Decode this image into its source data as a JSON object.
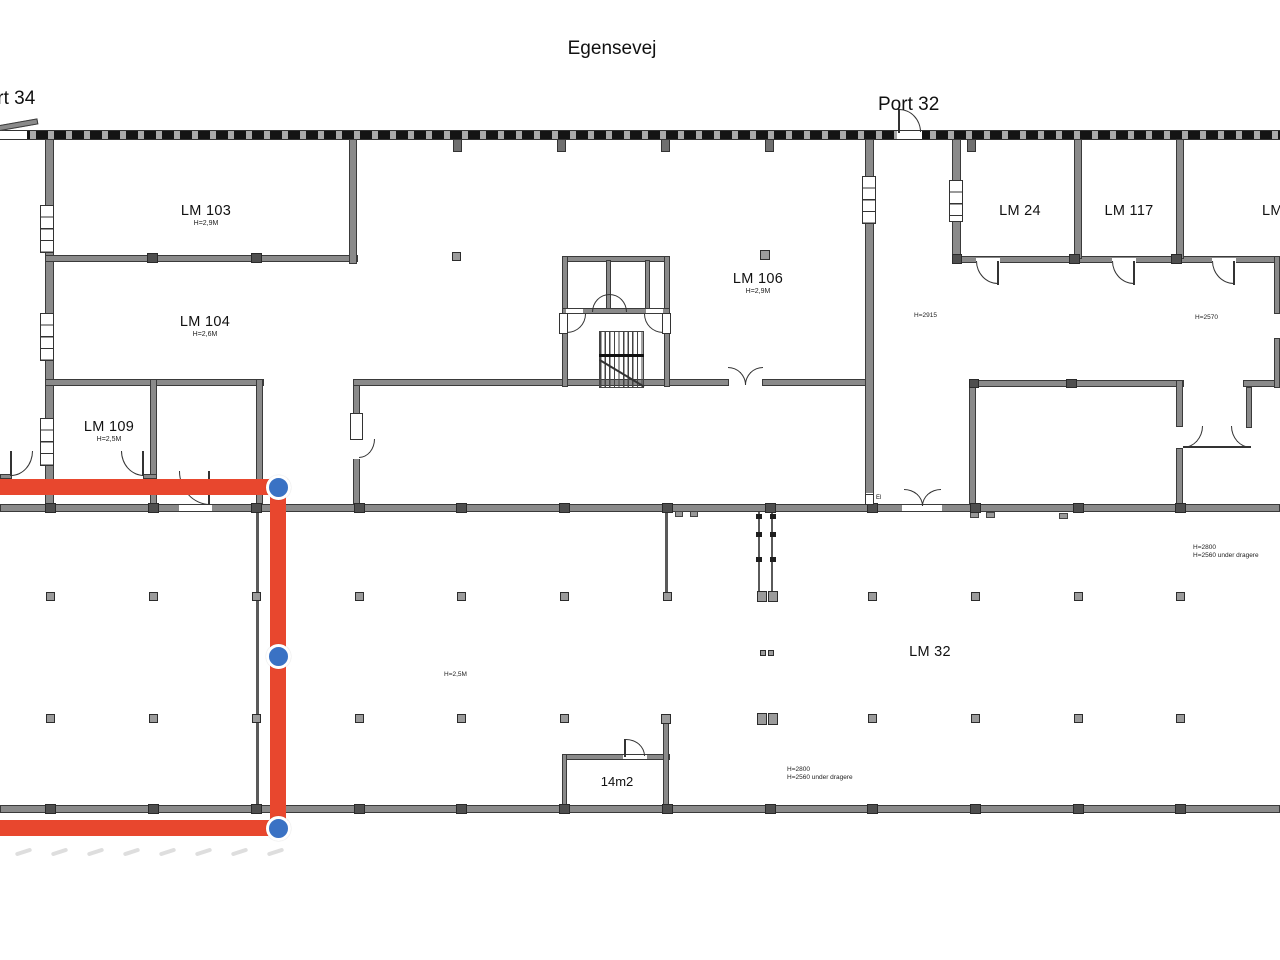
{
  "street_label": "Egensevej",
  "ports": {
    "port34": "Port 34",
    "port32": "Port 32"
  },
  "rooms": {
    "lm103": {
      "name": "LM 103",
      "height": "H=2,9M"
    },
    "lm104": {
      "name": "LM 104",
      "height": "H=2,6M"
    },
    "lm109": {
      "name": "LM 109",
      "height": "H=2,5M"
    },
    "lm106": {
      "name": "LM 106",
      "height": "H=2,9M"
    },
    "lm24": {
      "name": "LM 24"
    },
    "lm117": {
      "name": "LM 117"
    },
    "lm_edge": {
      "name": "LM"
    },
    "lm32": {
      "name": "LM 32"
    },
    "small_room": {
      "name": "14m2"
    }
  },
  "height_notes": {
    "open_hall_upper": "H=2915",
    "right_wing": "H=2570",
    "open_hall_lower": "H=2,5M",
    "mid_right_line1": "H=2800",
    "mid_right_line2": "H=2560 under dragere",
    "bottom_line1": "H=2800",
    "bottom_line2": "H=2560 under dragere",
    "el_box": "El"
  },
  "annotation": {
    "path_color": "#e8472e",
    "node_color": "#3a72c4",
    "nodes": [
      {
        "x": 278,
        "y": 487
      },
      {
        "x": 278,
        "y": 656
      },
      {
        "x": 278,
        "y": 828
      }
    ]
  }
}
